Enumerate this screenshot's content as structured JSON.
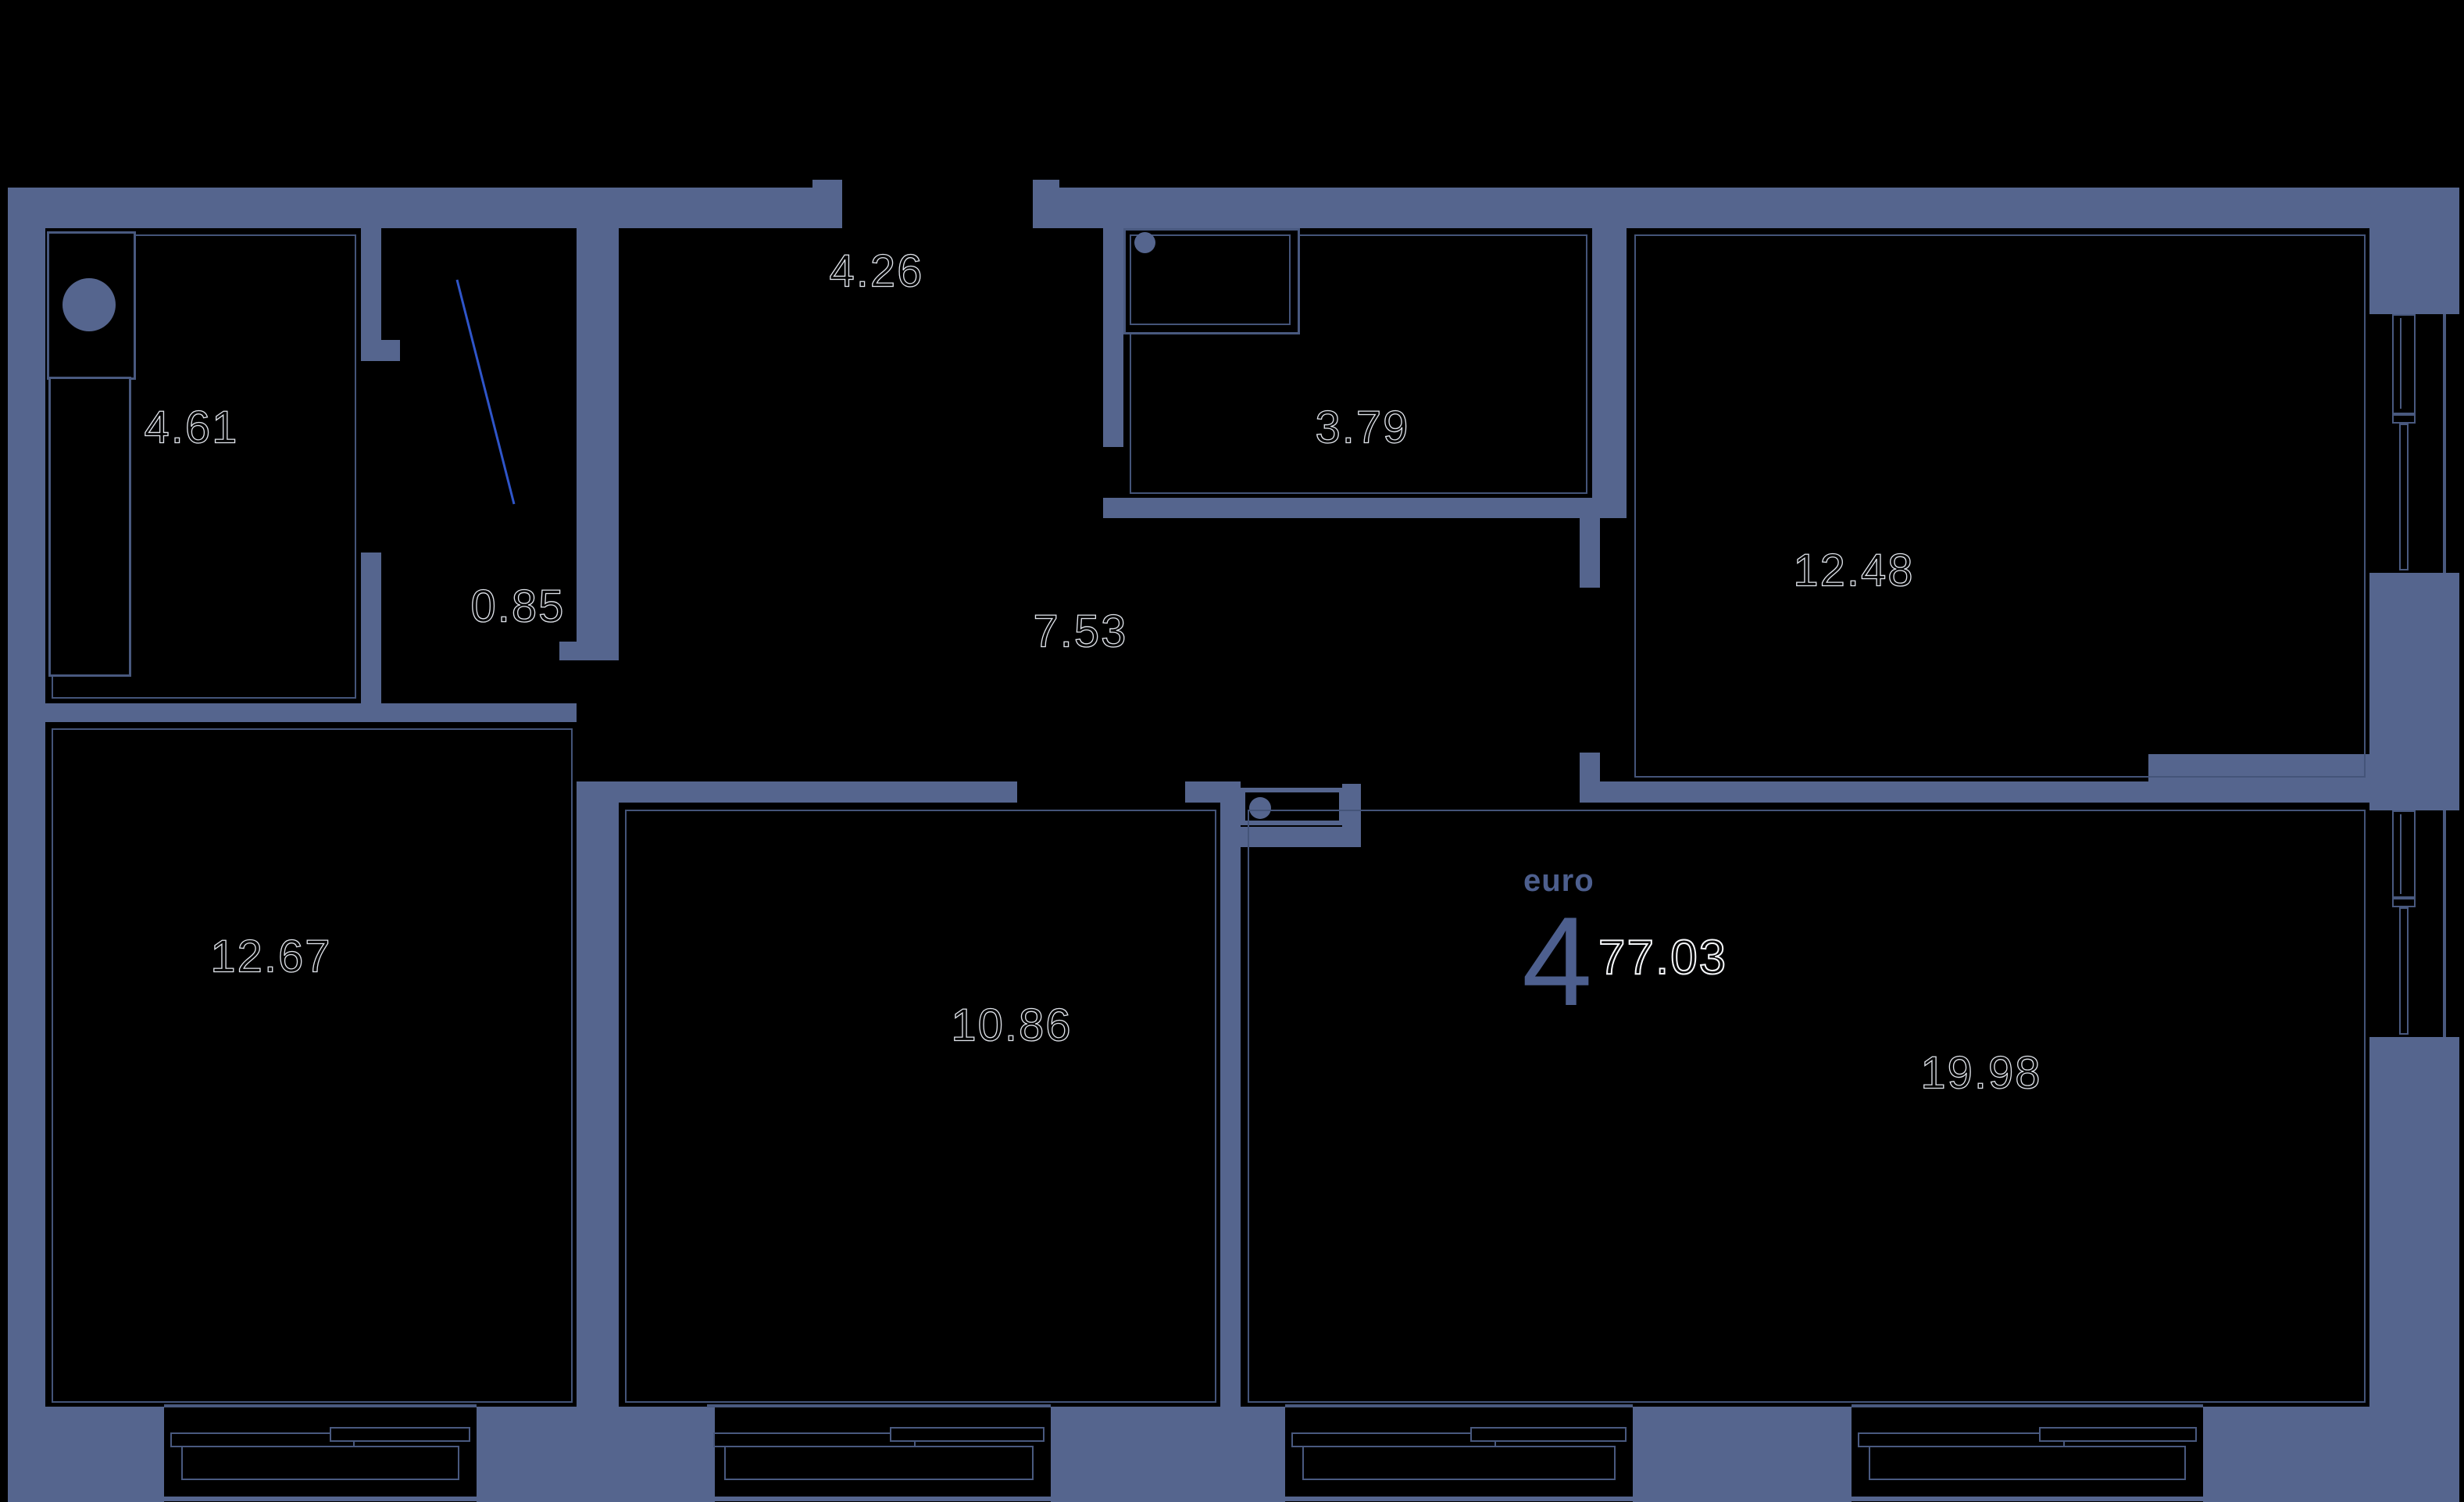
{
  "title": {
    "type_label": "euro",
    "rooms_count": "4",
    "total_area": "77.03"
  },
  "rooms": [
    {
      "name": "bathroom",
      "area": "4.61"
    },
    {
      "name": "niche",
      "area": "4.26"
    },
    {
      "name": "bathroom-2",
      "area": "3.79"
    },
    {
      "name": "bedroom",
      "area": "12.48"
    },
    {
      "name": "closet",
      "area": "0.85"
    },
    {
      "name": "hallway",
      "area": "7.53"
    },
    {
      "name": "bedroom-2",
      "area": "12.67"
    },
    {
      "name": "bedroom-3",
      "area": "10.86"
    },
    {
      "name": "living-kitchen",
      "area": "19.98"
    }
  ],
  "colors": {
    "wall": "#55658e",
    "thin_line": "#49597f",
    "door_swing": "#2f55c9",
    "background": "#000000",
    "accent_text": "#4d5f8e",
    "label_outline": "#dfe3ea"
  },
  "icons": {
    "washer": "washing-machine-circle",
    "sink": "sink-basin-circle",
    "panel": "electrical-panel-circle"
  }
}
